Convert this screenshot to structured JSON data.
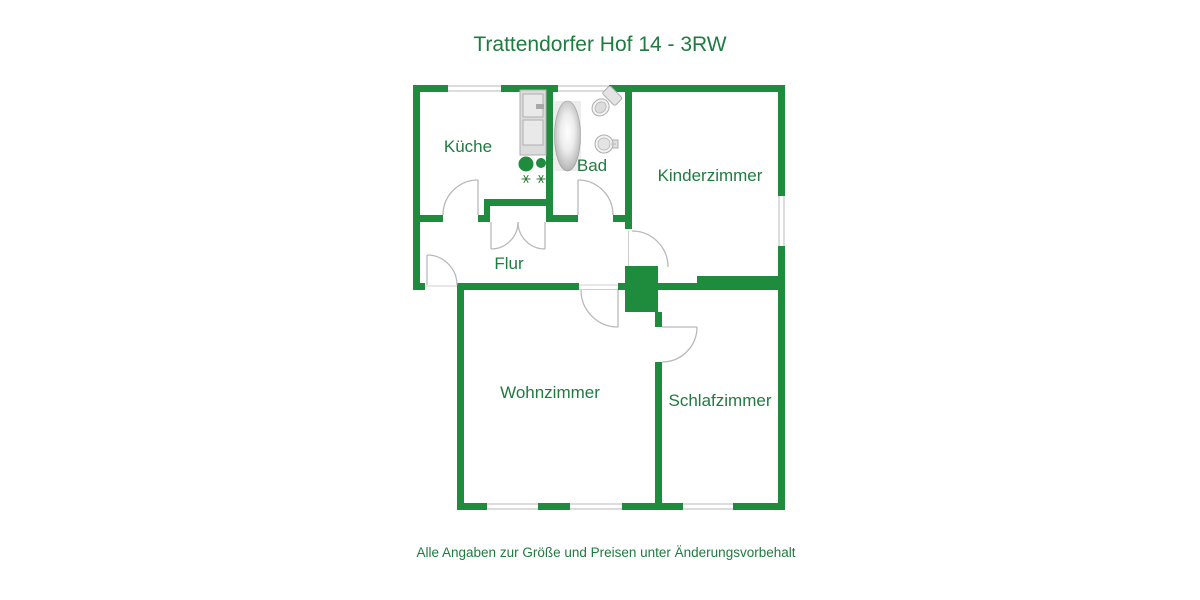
{
  "title": "Trattendorfer Hof 14 - 3RW",
  "caption": "Alle Angaben zur Größe und Preisen unter Änderungsvorbehalt",
  "colors": {
    "wall": "#1e8b3d",
    "text": "#1f7b40"
  },
  "rooms": [
    {
      "label": "Küche"
    },
    {
      "label": "Bad"
    },
    {
      "label": "Kinderzimmer"
    },
    {
      "label": "Flur"
    },
    {
      "label": "Wohnzimmer"
    },
    {
      "label": "Schlafzimmer"
    }
  ]
}
